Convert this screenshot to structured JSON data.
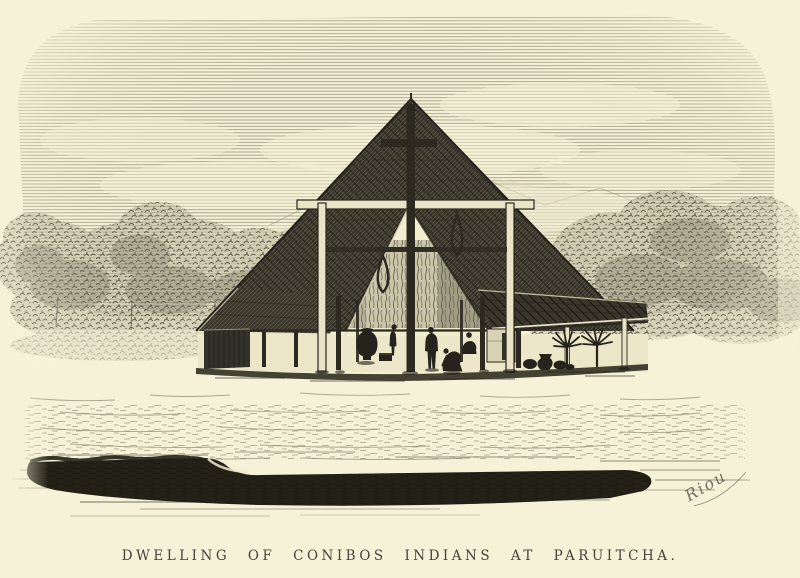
{
  "artwork": {
    "caption": "DWELLING OF CONIBOS INDIANS AT PARUITCHA.",
    "signature": "Riou",
    "colors": {
      "paper": "#f6f2d8",
      "ink": "#2c2921",
      "roof": "#3a362b",
      "sky_hatch": "#9e987f",
      "foliage": "#64604f",
      "caption_text": "#45423a",
      "highlight": "#e9e4c6"
    },
    "scene": {
      "subject": "open-sided pyramidal thatched dwelling in a forest clearing",
      "elements": [
        "pyramid thatch roof",
        "left wing with plank wall",
        "right wing with posts",
        "central post with crossbeam",
        "light timber frame",
        "hanging slings",
        "large clay urn",
        "figures beneath the roof",
        "palm plants",
        "pots on the ground",
        "forest background",
        "grassy midground",
        "dark riverbank foreground"
      ]
    }
  }
}
